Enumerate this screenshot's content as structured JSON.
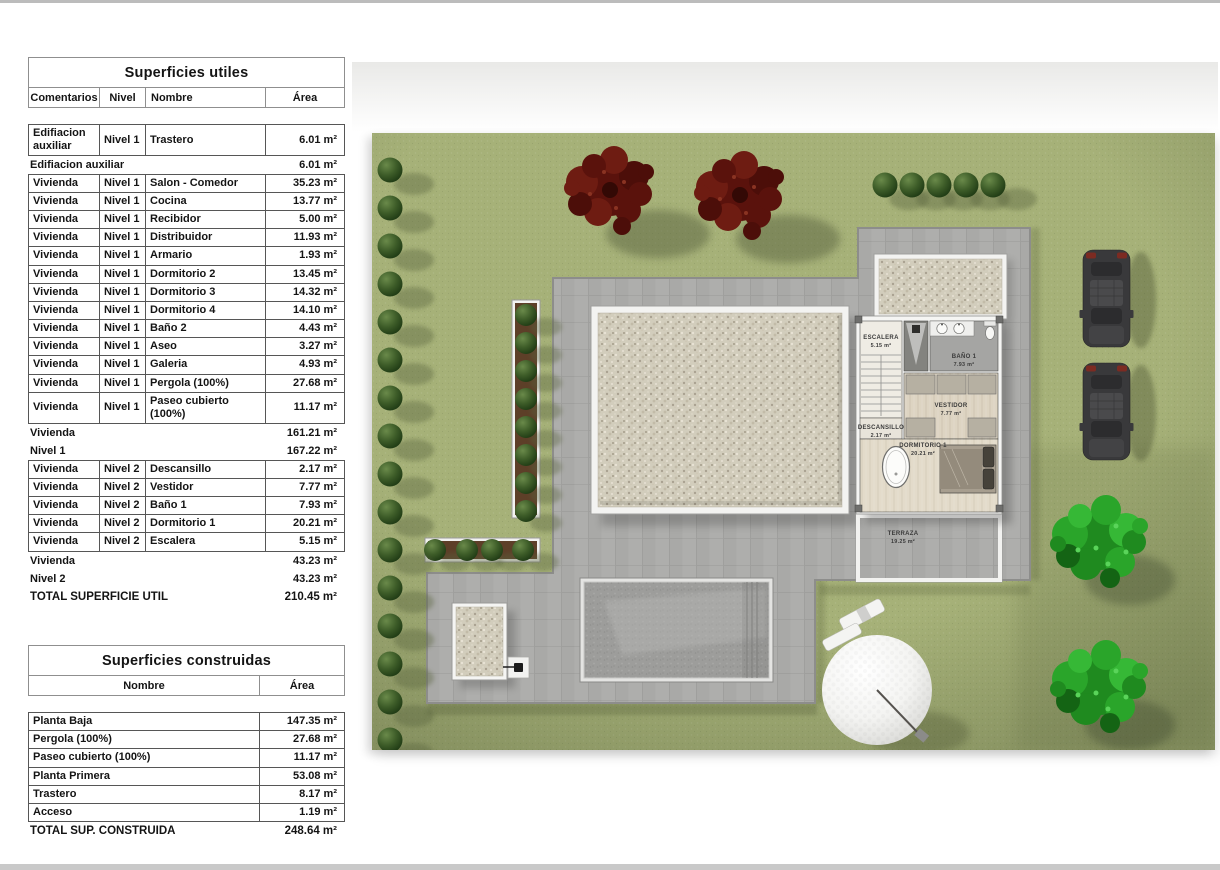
{
  "tables": {
    "utiles": {
      "title": "Superficies utiles",
      "headers": [
        "Comentarios",
        "Nivel",
        "Nombre",
        "Área"
      ],
      "rows": [
        {
          "kind": "data",
          "cells": [
            "Edifiacion auxiliar",
            "Nivel 1",
            "Trastero",
            "6.01 m²"
          ]
        },
        {
          "kind": "summary",
          "label": "Edifiacion auxiliar",
          "area": "6.01 m²"
        },
        {
          "kind": "data",
          "cells": [
            "Vivienda",
            "Nivel 1",
            "Salon - Comedor",
            "35.23 m²"
          ]
        },
        {
          "kind": "data",
          "cells": [
            "Vivienda",
            "Nivel 1",
            "Cocina",
            "13.77 m²"
          ]
        },
        {
          "kind": "data",
          "cells": [
            "Vivienda",
            "Nivel 1",
            "Recibidor",
            "5.00 m²"
          ]
        },
        {
          "kind": "data",
          "cells": [
            "Vivienda",
            "Nivel 1",
            "Distribuidor",
            "11.93 m²"
          ]
        },
        {
          "kind": "data",
          "cells": [
            "Vivienda",
            "Nivel 1",
            "Armario",
            "1.93 m²"
          ]
        },
        {
          "kind": "data",
          "cells": [
            "Vivienda",
            "Nivel 1",
            "Dormitorio 2",
            "13.45 m²"
          ]
        },
        {
          "kind": "data",
          "cells": [
            "Vivienda",
            "Nivel 1",
            "Dormitorio 3",
            "14.32 m²"
          ]
        },
        {
          "kind": "data",
          "cells": [
            "Vivienda",
            "Nivel 1",
            "Dormitorio 4",
            "14.10 m²"
          ]
        },
        {
          "kind": "data",
          "cells": [
            "Vivienda",
            "Nivel 1",
            "Baño 2",
            "4.43 m²"
          ]
        },
        {
          "kind": "data",
          "cells": [
            "Vivienda",
            "Nivel 1",
            "Aseo",
            "3.27 m²"
          ]
        },
        {
          "kind": "data",
          "cells": [
            "Vivienda",
            "Nivel 1",
            "Galeria",
            "4.93 m²"
          ]
        },
        {
          "kind": "data",
          "cells": [
            "Vivienda",
            "Nivel 1",
            "Pergola (100%)",
            "27.68 m²"
          ]
        },
        {
          "kind": "data",
          "cells": [
            "Vivienda",
            "Nivel 1",
            "Paseo cubierto (100%)",
            "11.17 m²"
          ]
        },
        {
          "kind": "summary",
          "label": "Vivienda",
          "area": "161.21 m²"
        },
        {
          "kind": "summary",
          "label": "Nivel 1",
          "area": "167.22 m²"
        },
        {
          "kind": "data",
          "cells": [
            "Vivienda",
            "Nivel 2",
            "Descansillo",
            "2.17 m²"
          ]
        },
        {
          "kind": "data",
          "cells": [
            "Vivienda",
            "Nivel 2",
            "Vestidor",
            "7.77 m²"
          ]
        },
        {
          "kind": "data",
          "cells": [
            "Vivienda",
            "Nivel 2",
            "Baño 1",
            "7.93 m²"
          ]
        },
        {
          "kind": "data",
          "cells": [
            "Vivienda",
            "Nivel 2",
            "Dormitorio 1",
            "20.21 m²"
          ]
        },
        {
          "kind": "data",
          "cells": [
            "Vivienda",
            "Nivel 2",
            "Escalera",
            "5.15 m²"
          ]
        },
        {
          "kind": "summary",
          "label": "Vivienda",
          "area": "43.23 m²"
        },
        {
          "kind": "summary",
          "label": "Nivel 2",
          "area": "43.23 m²"
        },
        {
          "kind": "total",
          "label": "TOTAL SUPERFICIE UTIL",
          "area": "210.45 m²"
        }
      ]
    },
    "construidas": {
      "title": "Superficies construidas",
      "headers": [
        "Nombre",
        "Área"
      ],
      "rows": [
        {
          "kind": "data",
          "cells": [
            "Planta Baja",
            "147.35 m²"
          ]
        },
        {
          "kind": "data",
          "cells": [
            "Pergola (100%)",
            "27.68 m²"
          ]
        },
        {
          "kind": "data",
          "cells": [
            "Paseo cubierto (100%)",
            "11.17 m²"
          ]
        },
        {
          "kind": "data",
          "cells": [
            "Planta Primera",
            "53.08 m²"
          ]
        },
        {
          "kind": "data",
          "cells": [
            "Trastero",
            "8.17 m²"
          ]
        },
        {
          "kind": "data",
          "cells": [
            "Acceso",
            "1.19 m²"
          ]
        },
        {
          "kind": "total",
          "label": "TOTAL SUP. CONSTRUIDA",
          "area": "248.64 m²"
        }
      ]
    }
  },
  "plan": {
    "labels": {
      "escalera": {
        "name": "ESCALERA",
        "area": "5.15 m²"
      },
      "banio1": {
        "name": "BAÑO 1",
        "area": "7.93 m²"
      },
      "descansillo": {
        "name": "DESCANSILLO",
        "area": "2.17 m²"
      },
      "vestidor": {
        "name": "VESTIDOR",
        "area": "7.77 m²"
      },
      "dormitorio1": {
        "name": "DORMITORIO 1",
        "area": "20.21 m²"
      },
      "terraza": {
        "name": "TERRAZA",
        "area": "19.25 m²"
      }
    },
    "colors": {
      "lawn": "#a6b178",
      "paving": "#aeaeac",
      "gravel": "#d2cdbc",
      "bush": "#2f4f21",
      "red_tree": "#5e130d",
      "green_tree": "#2aa12a",
      "pool": "#9d9d9b"
    }
  }
}
